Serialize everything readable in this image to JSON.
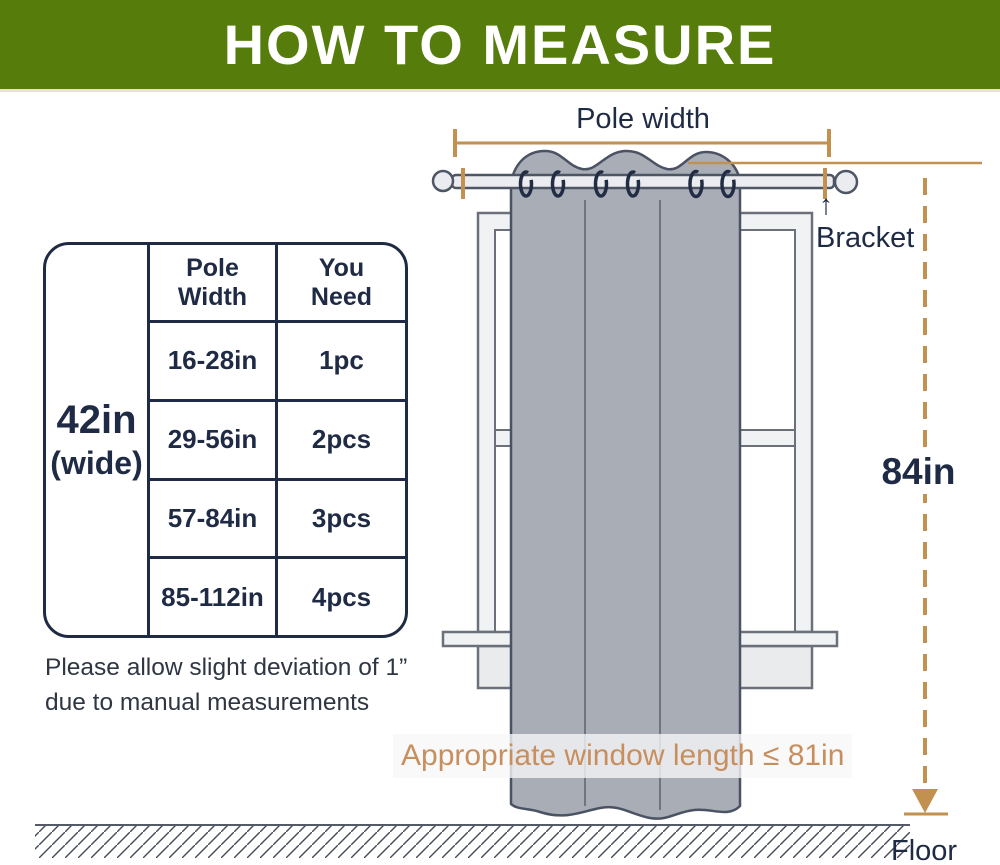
{
  "header": {
    "title": "HOW TO MEASURE"
  },
  "colors": {
    "green": "#567d0b",
    "navy": "#1f2b45",
    "tan": "#c2914f",
    "tan_text": "#c88f5e",
    "curtain": "#a9aeb6",
    "frame": "#6b707a",
    "note": "#2f3642"
  },
  "diagram": {
    "pole_width_label": "Pole width",
    "bracket_arrow": "↑",
    "bracket_label": "Bracket",
    "height_label": "84in",
    "window_length_label": "Appropriate window length ≤ 81in",
    "floor_label": "Floor"
  },
  "size_table": {
    "side_label_line1": "42in",
    "side_label_line2": "(wide)",
    "columns": [
      "Pole Width",
      "You Need"
    ],
    "rows": [
      [
        "16-28in",
        "1pc"
      ],
      [
        "29-56in",
        "2pcs"
      ],
      [
        "57-84in",
        "3pcs"
      ],
      [
        "85-112in",
        "4pcs"
      ]
    ]
  },
  "note": {
    "line1": "Please allow slight deviation of 1”",
    "line2": "due to manual measurements"
  }
}
